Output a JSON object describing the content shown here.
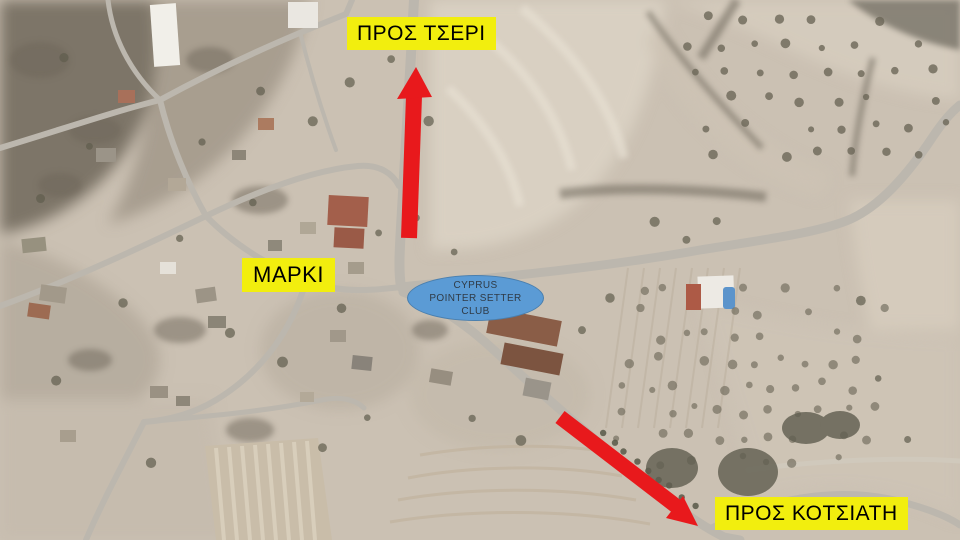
{
  "labels": {
    "tseri": {
      "text": "ΠΡΟΣ ΤΣΕΡΙ"
    },
    "marki": {
      "text": "ΜΑΡΚΙ"
    },
    "kotsiati": {
      "text": "ΠΡΟΣ ΚΟΤΣΙΑΤΗ"
    }
  },
  "club_badge": {
    "line1": "CYPRUS",
    "line2": "POINTER SETTER",
    "line3": "CLUB"
  },
  "arrows": {
    "tseri": {
      "icon": "red-arrow-up",
      "points_to": "ΠΡΟΣ ΤΣΕΡΙ"
    },
    "kotsiati": {
      "icon": "red-arrow-down-right",
      "points_to": "ΠΡΟΣ ΚΟΤΣΙΑΤΗ"
    }
  },
  "colors": {
    "label-bg": "#f2ee0e",
    "label-text": "#000000",
    "arrow-red": "#e8191c",
    "badge-bg": "#5b9bd5",
    "badge-border": "#4a7fae",
    "badge-text": "#2f3b47"
  }
}
